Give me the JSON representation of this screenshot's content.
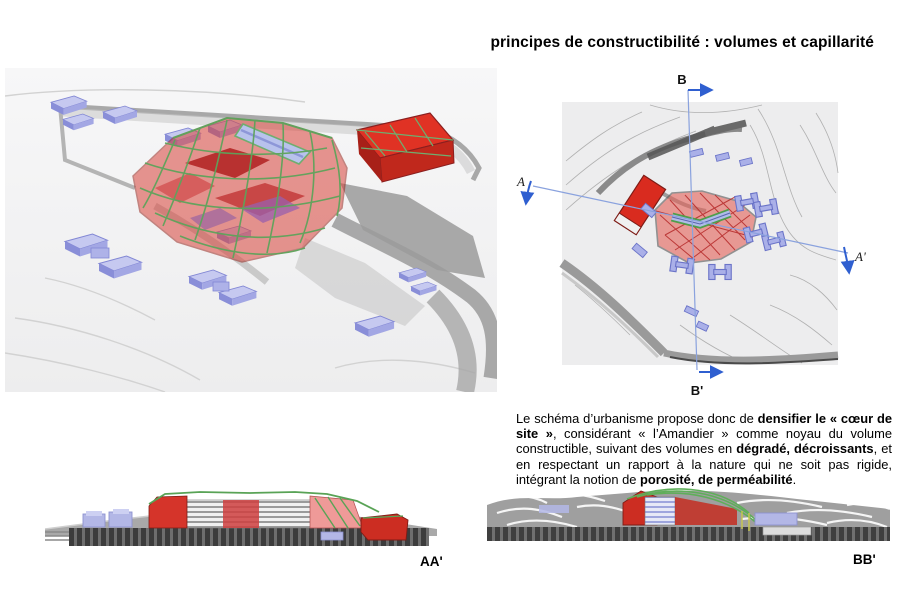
{
  "title": "principes de constructibilité : volumes et capillarité",
  "colors": {
    "volume_red": "#d92b1f",
    "building_blue": "#a9aee0",
    "mesh_green": "#5fa45c",
    "section_line_blue": "#2f5fd0",
    "terrain_gray": "#9f9f9f"
  },
  "plan": {
    "label_b": "B",
    "label_b_prime": "B'",
    "label_a": "A",
    "label_a_prime": "A'"
  },
  "paragraph": {
    "segments": [
      {
        "text": "Le schéma d’urbanisme propose donc de ",
        "bold": false
      },
      {
        "text": "densifier le « cœur de site  »",
        "bold": true
      },
      {
        "text": ", considérant « l’Amandier » comme noyau du volume constructible, suivant des volumes en ",
        "bold": false
      },
      {
        "text": "dégradé, décroissants",
        "bold": true
      },
      {
        "text": ", et en respectant un rapport à la nature qui ne soit pas rigide, intégrant la notion de ",
        "bold": false
      },
      {
        "text": "porosité, de perméabilité",
        "bold": true
      },
      {
        "text": ".",
        "bold": false
      }
    ]
  },
  "sections": {
    "aa_label": "AA'",
    "bb_label": "BB'"
  }
}
